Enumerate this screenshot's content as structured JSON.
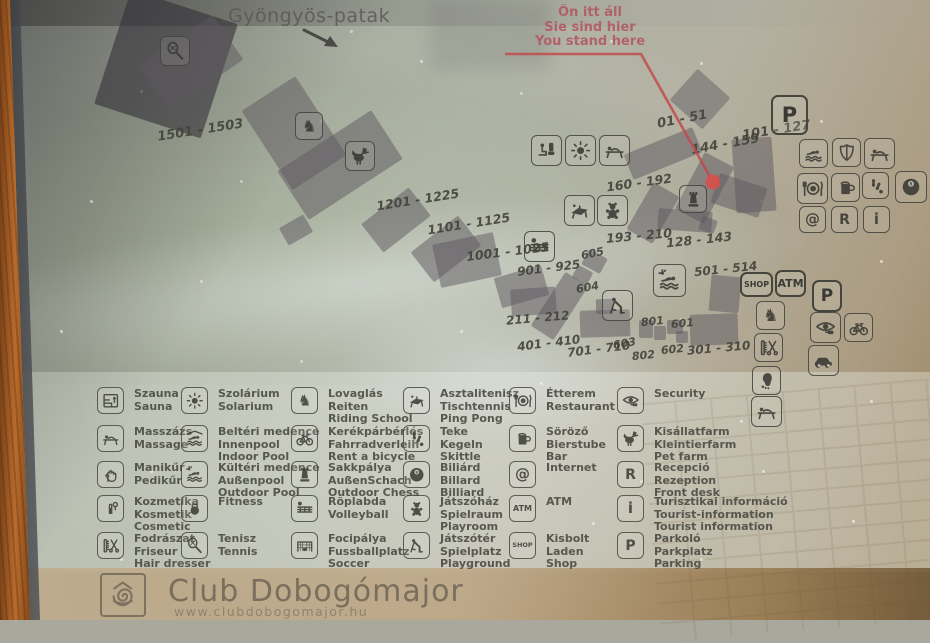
{
  "sign": {
    "river_label": "Gyöngyös-patak",
    "you_are_here": {
      "line1": "Ön itt áll",
      "line2": "Sie sind hier",
      "line3": "You stand here"
    },
    "footer": {
      "title": "Club Dobogómajor",
      "url": "www.clubdobogomajor.hu",
      "logo_icon": "snail-logo-icon"
    },
    "colors": {
      "accent_red": "#c14b4b",
      "marker_dot": "#d6504a",
      "building": "#5d5760",
      "label_text": "#42423a",
      "wood_frame": "#b96c2b"
    }
  },
  "map": {
    "labels": [
      {
        "text": "1501 - 1503",
        "x": 157,
        "y": 123,
        "rot": -9,
        "fs": 13
      },
      {
        "text": "1201 - 1225",
        "x": 376,
        "y": 192,
        "rot": -9,
        "fs": 12.5
      },
      {
        "text": "1101 - 1125",
        "x": 427,
        "y": 216,
        "rot": -9,
        "fs": 12.5
      },
      {
        "text": "1001 - 1025",
        "x": 466,
        "y": 244,
        "rot": -7,
        "fs": 12.5
      },
      {
        "text": "901 - 925",
        "x": 517,
        "y": 261,
        "rot": -7,
        "fs": 12
      },
      {
        "text": "605",
        "x": 581,
        "y": 247,
        "rot": -12,
        "fs": 11
      },
      {
        "text": "604",
        "x": 576,
        "y": 281,
        "rot": -10,
        "fs": 11
      },
      {
        "text": "211 - 212",
        "x": 506,
        "y": 311,
        "rot": -5,
        "fs": 12
      },
      {
        "text": "401 - 410",
        "x": 517,
        "y": 336,
        "rot": -7,
        "fs": 12
      },
      {
        "text": "701 - 710",
        "x": 567,
        "y": 342,
        "rot": -7,
        "fs": 12
      },
      {
        "text": "603",
        "x": 613,
        "y": 337,
        "rot": -10,
        "fs": 11
      },
      {
        "text": "802",
        "x": 632,
        "y": 349,
        "rot": -6,
        "fs": 11
      },
      {
        "text": "801",
        "x": 641,
        "y": 315,
        "rot": -6,
        "fs": 11
      },
      {
        "text": "601",
        "x": 671,
        "y": 317,
        "rot": -6,
        "fs": 11
      },
      {
        "text": "602",
        "x": 661,
        "y": 343,
        "rot": -6,
        "fs": 11
      },
      {
        "text": "301 - 310",
        "x": 687,
        "y": 341,
        "rot": -5,
        "fs": 12
      },
      {
        "text": "01 - 51",
        "x": 657,
        "y": 112,
        "rot": -11,
        "fs": 13
      },
      {
        "text": "144 - 159",
        "x": 691,
        "y": 137,
        "rot": -10,
        "fs": 13
      },
      {
        "text": "101 - 127",
        "x": 742,
        "y": 123,
        "rot": -9,
        "fs": 13
      },
      {
        "text": "160 - 192",
        "x": 606,
        "y": 175,
        "rot": -8,
        "fs": 12.5
      },
      {
        "text": "193 - 210",
        "x": 606,
        "y": 228,
        "rot": -5,
        "fs": 12.5
      },
      {
        "text": "128 - 143",
        "x": 666,
        "y": 232,
        "rot": -6,
        "fs": 12.5
      },
      {
        "text": "501 - 514",
        "x": 694,
        "y": 262,
        "rot": -6,
        "fs": 12
      }
    ],
    "buildings": [
      {
        "x": 110,
        "y": 4,
        "w": 112,
        "h": 120,
        "rot": 18,
        "c": "rgba(48,44,54,.58)"
      },
      {
        "x": 146,
        "y": 36,
        "w": 90,
        "h": 54,
        "rot": -35
      },
      {
        "x": 262,
        "y": 86,
        "w": 64,
        "h": 94,
        "rot": -33
      },
      {
        "x": 284,
        "y": 136,
        "w": 112,
        "h": 58,
        "rot": -33
      },
      {
        "x": 282,
        "y": 220,
        "w": 28,
        "h": 20,
        "rot": -30
      },
      {
        "x": 366,
        "y": 202,
        "w": 60,
        "h": 36,
        "rot": -38
      },
      {
        "x": 416,
        "y": 230,
        "w": 60,
        "h": 38,
        "rot": -38
      },
      {
        "x": 436,
        "y": 238,
        "w": 62,
        "h": 44,
        "rot": -12
      },
      {
        "x": 497,
        "y": 271,
        "w": 49,
        "h": 31,
        "rot": -16
      },
      {
        "x": 511,
        "y": 288,
        "w": 45,
        "h": 27,
        "rot": -4
      },
      {
        "x": 546,
        "y": 274,
        "w": 27,
        "h": 64,
        "rot": 33
      },
      {
        "x": 584,
        "y": 253,
        "w": 21,
        "h": 17,
        "rot": 28
      },
      {
        "x": 574,
        "y": 268,
        "w": 17,
        "h": 14,
        "rot": 28
      },
      {
        "x": 580,
        "y": 310,
        "w": 50,
        "h": 27,
        "rot": -2
      },
      {
        "x": 596,
        "y": 299,
        "w": 17,
        "h": 15,
        "rot": -2
      },
      {
        "x": 639,
        "y": 320,
        "w": 14,
        "h": 18,
        "rot": 0
      },
      {
        "x": 654,
        "y": 326,
        "w": 12,
        "h": 14,
        "rot": 0
      },
      {
        "x": 667,
        "y": 320,
        "w": 16,
        "h": 14,
        "rot": 0
      },
      {
        "x": 676,
        "y": 331,
        "w": 12,
        "h": 12,
        "rot": 0
      },
      {
        "x": 690,
        "y": 314,
        "w": 48,
        "h": 31,
        "rot": -2
      },
      {
        "x": 710,
        "y": 276,
        "w": 30,
        "h": 36,
        "rot": 5
      },
      {
        "x": 678,
        "y": 78,
        "w": 44,
        "h": 42,
        "rot": 42,
        "c": "rgba(100,95,100,.5)"
      },
      {
        "x": 626,
        "y": 140,
        "w": 74,
        "h": 27,
        "rot": -22
      },
      {
        "x": 688,
        "y": 156,
        "w": 33,
        "h": 64,
        "rot": 28
      },
      {
        "x": 734,
        "y": 138,
        "w": 40,
        "h": 74,
        "rot": -4
      },
      {
        "x": 714,
        "y": 180,
        "w": 50,
        "h": 31,
        "rot": 18
      },
      {
        "x": 638,
        "y": 186,
        "w": 30,
        "h": 54,
        "rot": 30
      },
      {
        "x": 658,
        "y": 210,
        "w": 54,
        "h": 21,
        "rot": 4
      },
      {
        "x": 700,
        "y": 218,
        "w": 16,
        "h": 14,
        "rot": 20
      }
    ],
    "icons": [
      {
        "name": "tennis-racket-icon",
        "x": 160,
        "y": 36,
        "s": 30
      },
      {
        "name": "riding-icon",
        "x": 295,
        "y": 112,
        "s": 28
      },
      {
        "name": "petfarm-icon",
        "x": 345,
        "y": 141,
        "s": 30
      },
      {
        "name": "wc-icon",
        "x": 531,
        "y": 135,
        "s": 31
      },
      {
        "name": "solarium-icon",
        "x": 565,
        "y": 135,
        "s": 31
      },
      {
        "name": "massage-icon",
        "x": 599,
        "y": 135,
        "s": 31
      },
      {
        "name": "pingpong-icon",
        "x": 564,
        "y": 195,
        "s": 31
      },
      {
        "name": "playroom-icon",
        "x": 597,
        "y": 195,
        "s": 31
      },
      {
        "name": "chess-icon",
        "x": 679,
        "y": 185,
        "s": 28
      },
      {
        "name": "volleyball-icon",
        "x": 524,
        "y": 231,
        "s": 31
      },
      {
        "name": "playground-icon",
        "x": 602,
        "y": 290,
        "s": 31
      },
      {
        "name": "outdoor-pool-icon",
        "x": 653,
        "y": 264,
        "s": 33
      },
      {
        "name": "swimmer-icon",
        "x": 799,
        "y": 139,
        "s": 29
      },
      {
        "name": "security-shield-icon",
        "x": 832,
        "y": 138,
        "s": 29
      },
      {
        "name": "massage-icon",
        "x": 864,
        "y": 138,
        "s": 31
      },
      {
        "name": "restaurant-icon",
        "x": 797,
        "y": 173,
        "s": 31
      },
      {
        "name": "bar-icon",
        "x": 831,
        "y": 173,
        "s": 29
      },
      {
        "name": "skittle-icon",
        "x": 862,
        "y": 172,
        "s": 27
      },
      {
        "name": "billiard-icon",
        "x": 895,
        "y": 171,
        "s": 32
      },
      {
        "name": "internet-icon",
        "x": 799,
        "y": 206,
        "s": 27
      },
      {
        "name": "reception-icon",
        "x": 831,
        "y": 206,
        "s": 27
      },
      {
        "name": "info-icon",
        "x": 863,
        "y": 206,
        "s": 27
      },
      {
        "name": "horse-head-icon",
        "x": 756,
        "y": 301,
        "s": 29
      },
      {
        "name": "hairdresser-icon",
        "x": 754,
        "y": 333,
        "s": 29
      },
      {
        "name": "foot-icon",
        "x": 752,
        "y": 366,
        "s": 29
      },
      {
        "name": "massage-icon",
        "x": 751,
        "y": 396,
        "s": 31
      },
      {
        "name": "security-icon",
        "x": 810,
        "y": 312,
        "s": 31
      },
      {
        "name": "bicycle-icon",
        "x": 844,
        "y": 313,
        "s": 29
      },
      {
        "name": "car-icon",
        "x": 808,
        "y": 345,
        "s": 31
      }
    ],
    "badges": [
      {
        "text": "P",
        "x": 771,
        "y": 95,
        "w": 37,
        "h": 40,
        "fs": 21
      },
      {
        "text": "P",
        "x": 812,
        "y": 280,
        "w": 30,
        "h": 32,
        "fs": 17
      },
      {
        "text": "SHOP",
        "x": 740,
        "y": 272,
        "w": 33,
        "h": 25,
        "fs": 8
      },
      {
        "text": "ATM",
        "x": 775,
        "y": 270,
        "w": 31,
        "h": 27,
        "fs": 11
      }
    ]
  },
  "legend": {
    "columns": [
      {
        "items": [
          {
            "icon": "sauna-icon",
            "lines": [
              "Szauna",
              "Sauna"
            ]
          },
          {
            "icon": "massage-icon",
            "lines": [
              "Masszázs",
              "Massage"
            ]
          },
          {
            "icon": "manicure-icon",
            "lines": [
              "Manikűr",
              "Pedikűr"
            ]
          },
          {
            "icon": "cosmetic-icon",
            "lines": [
              "Kozmetika",
              "Kosmetik",
              "Cosmetic"
            ]
          },
          {
            "icon": "hairdresser-icon",
            "lines": [
              "Fodrászat",
              "Friseur",
              "Hair dresser"
            ]
          }
        ]
      },
      {
        "items": [
          {
            "icon": "solarium-icon",
            "lines": [
              "Szolárium",
              "Solarium"
            ]
          },
          {
            "icon": "indoor-pool-icon",
            "lines": [
              "Beltéri medence",
              "Innenpool",
              "Indoor Pool"
            ]
          },
          {
            "icon": "outdoor-pool-icon",
            "lines": [
              "Kültéri medence",
              "Außenpool",
              "Outdoor Pool"
            ]
          },
          {
            "icon": "fitness-icon",
            "lines": [
              "Fitness"
            ]
          },
          {
            "icon": "tennis-racket-icon",
            "lines": [
              "Tenisz",
              "Tennis"
            ]
          }
        ]
      },
      {
        "items": [
          {
            "icon": "riding-icon",
            "lines": [
              "Lovaglás",
              "Reiten",
              "Riding School"
            ]
          },
          {
            "icon": "bicycle-icon",
            "lines": [
              "Kerékpárbérlés",
              "Fahrradverleih",
              "Rent a bicycle"
            ]
          },
          {
            "icon": "chess-icon",
            "lines": [
              "Sakkpálya",
              "AußenSchach",
              "Outdoor Chess"
            ]
          },
          {
            "icon": "volleyball-icon",
            "lines": [
              "Röplabda",
              "Volleyball"
            ]
          },
          {
            "icon": "soccer-icon",
            "lines": [
              "Focipálya",
              "Fussballplatz",
              "Soccer"
            ]
          }
        ]
      },
      {
        "items": [
          {
            "icon": "pingpong-icon",
            "lines": [
              "Asztalitenisz",
              "Tischtennis",
              "Ping Pong"
            ]
          },
          {
            "icon": "skittle-icon",
            "lines": [
              "Teke",
              "Kegeln",
              "Skittle"
            ]
          },
          {
            "icon": "billiard-icon",
            "lines": [
              "Biliárd",
              "Billard",
              "Billiard"
            ]
          },
          {
            "icon": "playroom-icon",
            "lines": [
              "Játszóház",
              "Spielraum",
              "Playroom"
            ]
          },
          {
            "icon": "playground-icon",
            "lines": [
              "Játszótér",
              "Spielplatz",
              "Playground"
            ]
          }
        ]
      },
      {
        "items": [
          {
            "icon": "restaurant-icon",
            "lines": [
              "Étterem",
              "Restaurant"
            ]
          },
          {
            "icon": "bar-icon",
            "lines": [
              "Söröző",
              "Bierstube",
              "Bar"
            ]
          },
          {
            "icon": "internet-icon",
            "lines": [
              "Internet"
            ]
          },
          {
            "icon": "atm-icon",
            "lines": [
              "ATM"
            ]
          },
          {
            "icon": "shop-icon",
            "lines": [
              "Kisbolt",
              "Laden",
              "Shop"
            ]
          }
        ]
      },
      {
        "items": [
          {
            "icon": "security-icon",
            "lines": [
              "Security"
            ]
          },
          {
            "icon": "petfarm-icon",
            "lines": [
              "Kisállatfarm",
              "Kleintierfarm",
              "Pet farm"
            ]
          },
          {
            "icon": "reception-icon",
            "lines": [
              "Recepció",
              "Rezeption",
              "Front desk"
            ]
          },
          {
            "icon": "info-icon",
            "lines": [
              "Turisztikai információ",
              "Tourist-information",
              "Tourist information"
            ]
          },
          {
            "icon": "parking-icon",
            "lines": [
              "Parkoló",
              "Parkplatz",
              "Parking"
            ]
          }
        ]
      }
    ]
  }
}
